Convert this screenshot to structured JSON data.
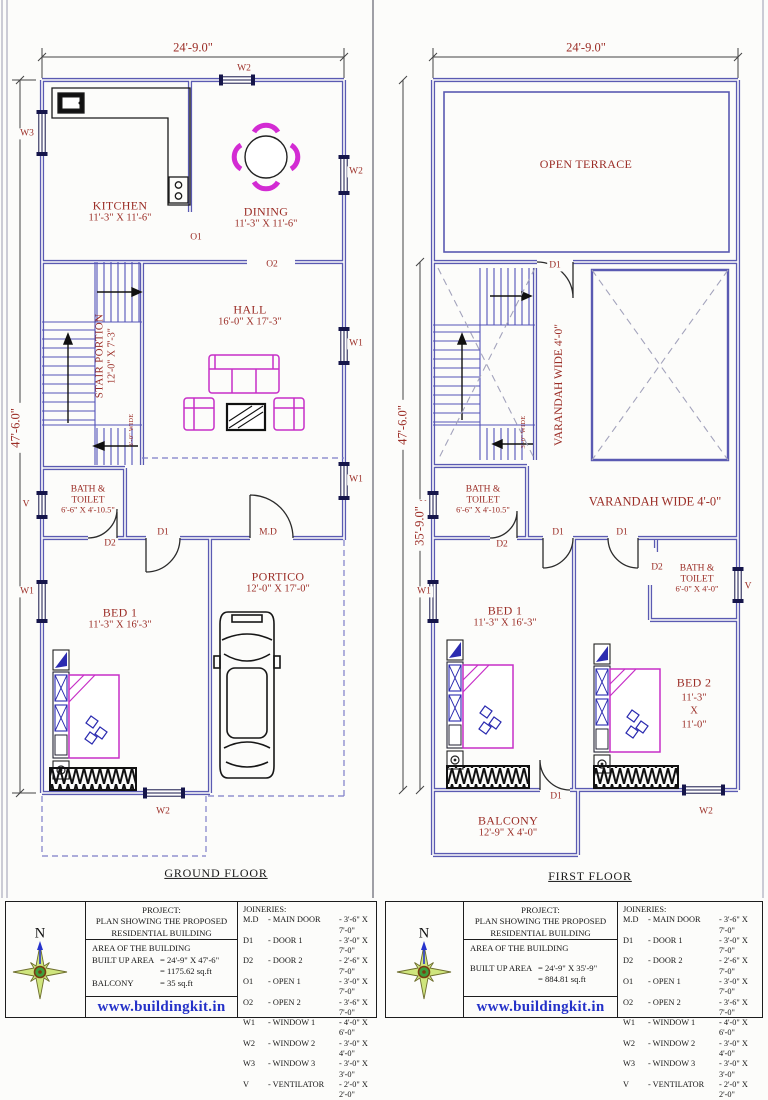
{
  "plans": {
    "ground": {
      "caption": "GROUND FLOOR",
      "dim_width": "24'-9.0\"",
      "dim_height": "47'-6.0\"",
      "rooms": {
        "kitchen": {
          "name": "KITCHEN",
          "dim": "11'-3\" X 11'-6\""
        },
        "dining": {
          "name": "DINING",
          "dim": "11'-3\" X 11'-6\""
        },
        "hall": {
          "name": "HALL",
          "dim": "16'-0\" X 17'-3\""
        },
        "stair": {
          "name": "STAIR PORTION",
          "dim": "12'-0\" X 7'-3\"",
          "width_note": "3'-0\" WIDE"
        },
        "bath": {
          "line1": "BATH &",
          "line2": "TOILET",
          "dim": "6'-6\" X 4'-10.5\""
        },
        "bed1": {
          "name": "BED 1",
          "dim": "11'-3\" X 16'-3\""
        },
        "portico": {
          "name": "PORTICO",
          "dim": "12'-0\" X 17'-0\""
        }
      },
      "openings": {
        "o1": "O1",
        "o2": "O2",
        "d1": "D1",
        "d2": "D2",
        "md": "M.D",
        "w1": "W1",
        "w2": "W2",
        "w3": "W3",
        "v": "V"
      }
    },
    "first": {
      "caption": "FIRST FLOOR",
      "dim_width": "24'-9.0\"",
      "dim_height_outer": "47'-6.0\"",
      "dim_height_inner": "35'-9.0\"",
      "rooms": {
        "terrace": {
          "name": "OPEN TERRACE"
        },
        "varandah_vertical": {
          "name": "VARANDAH WIDE 4'-0\""
        },
        "varandah_horizontal": {
          "name": "VARANDAH WIDE 4'-0\""
        },
        "stair": {
          "width_note": "3'-0\" WIDE"
        },
        "bath1": {
          "line1": "BATH &",
          "line2": "TOILET",
          "dim": "6'-6\" X 4'-10.5\""
        },
        "bath2": {
          "line1": "BATH &",
          "line2": "TOILET",
          "dim": "6'-0\" X 4'-0\""
        },
        "bed1": {
          "name": "BED 1",
          "dim": "11'-3\" X 16'-3\""
        },
        "bed2": {
          "name": "BED 2",
          "dim_line1": "11'-3\"",
          "dim_line2": "X",
          "dim_line3": "11'-0\""
        },
        "balcony": {
          "name": "BALCONY",
          "dim": "12'-9\" X 4'-0\""
        }
      },
      "openings": {
        "d1": "D1",
        "d2": "D2",
        "w1": "W1",
        "w2": "W2",
        "v": "V"
      }
    }
  },
  "title_blocks": [
    {
      "north_label": "N",
      "project_title": "PROJECT:",
      "project_line1": "PLAN SHOWING THE PROPOSED",
      "project_line2": "RESIDENTIAL BUILDING",
      "area_title": "AREA OF THE BUILDING",
      "area_rows": [
        {
          "label": "BUILT UP AREA",
          "value": "= 24'-9\" X 47'-6\""
        },
        {
          "label": "",
          "value": "= 1175.62 sq.ft"
        },
        {
          "label": "BALCONY",
          "value": "= 35 sq.ft"
        }
      ],
      "website": "www.buildingkit.in",
      "joineries_title": "JOINERIES:",
      "joineries": [
        {
          "code": "M.D",
          "name": "- MAIN DOOR",
          "size": "- 3'-6\" X 7'-0\""
        },
        {
          "code": "D1",
          "name": "- DOOR 1",
          "size": "- 3'-0\" X 7'-0\""
        },
        {
          "code": "D2",
          "name": "- DOOR 2",
          "size": "- 2'-6\" X 7'-0\""
        },
        {
          "code": "O1",
          "name": "- OPEN 1",
          "size": "- 3'-0\" X 7'-0\""
        },
        {
          "code": "O2",
          "name": "- OPEN 2",
          "size": "- 3'-6\" X 7'-0\""
        },
        {
          "code": "W1",
          "name": "- WINDOW 1",
          "size": "- 4'-0\" X 6'-0\""
        },
        {
          "code": "W2",
          "name": "- WINDOW 2",
          "size": "- 3'-0\" X 4'-0\""
        },
        {
          "code": "W3",
          "name": "- WINDOW 3",
          "size": "- 3'-0\" X 3'-0\""
        },
        {
          "code": "V",
          "name": "- VENTILATOR",
          "size": "- 2'-0\" X 2'-0\""
        }
      ]
    },
    {
      "north_label": "N",
      "project_title": "PROJECT:",
      "project_line1": "PLAN SHOWING THE PROPOSED",
      "project_line2": "RESIDENTIAL BUILDING",
      "area_title": "AREA OF THE BUILDING",
      "area_rows": [
        {
          "label": "BUILT UP AREA",
          "value": "= 24'-9\" X 35'-9\""
        },
        {
          "label": "",
          "value": "= 884.81 sq.ft"
        }
      ],
      "website": "www.buildingkit.in",
      "joineries_title": "JOINERIES:",
      "joineries": [
        {
          "code": "M.D",
          "name": "- MAIN DOOR",
          "size": "- 3'-6\" X 7'-0\""
        },
        {
          "code": "D1",
          "name": "- DOOR 1",
          "size": "- 3'-0\" X 7'-0\""
        },
        {
          "code": "D2",
          "name": "- DOOR 2",
          "size": "- 2'-6\" X 7'-0\""
        },
        {
          "code": "O1",
          "name": "- OPEN 1",
          "size": "- 3'-0\" X 7'-0\""
        },
        {
          "code": "O2",
          "name": "- OPEN 2",
          "size": "- 3'-6\" X 7'-0\""
        },
        {
          "code": "W1",
          "name": "- WINDOW 1",
          "size": "- 4'-0\" X 6'-0\""
        },
        {
          "code": "W2",
          "name": "- WINDOW 2",
          "size": "- 3'-0\" X 4'-0\""
        },
        {
          "code": "W3",
          "name": "- WINDOW 3",
          "size": "- 3'-0\" X 3'-0\""
        },
        {
          "code": "V",
          "name": "- VENTILATOR",
          "size": "- 2'-0\" X 2'-0\""
        }
      ]
    }
  ]
}
